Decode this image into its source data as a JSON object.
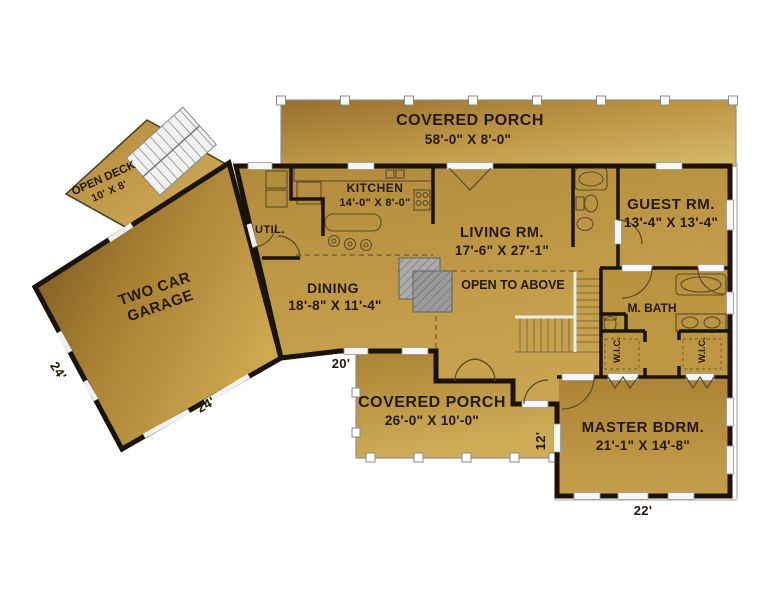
{
  "plan": {
    "rooms": {
      "porch_top": {
        "name": "COVERED PORCH",
        "dims": "58'-0\" X 8'-0\""
      },
      "kitchen": {
        "name": "KITCHEN",
        "dims": "14'-0\" X 8'-0\""
      },
      "util": {
        "name": "UTIL."
      },
      "guest": {
        "name": "GUEST RM.",
        "dims": "13'-4\" X 13'-4\""
      },
      "living": {
        "name": "LIVING RM.",
        "dims": "17'-6\" X 27'-1\""
      },
      "open_above": {
        "name": "OPEN TO ABOVE"
      },
      "dining": {
        "name": "DINING",
        "dims": "18'-8\" X 11'-4\""
      },
      "mbath": {
        "name": "M. BATH"
      },
      "wic_left": {
        "name": "W.I.C."
      },
      "wic_right": {
        "name": "W.I.C."
      },
      "garage": {
        "line1": "TWO CAR",
        "line2": "GARAGE"
      },
      "deck": {
        "name": "OPEN DECK",
        "dims": "10' X 8'"
      },
      "porch_bottom": {
        "name": "COVERED PORCH",
        "dims": "26'-0\" X 10'-0\""
      },
      "master": {
        "name": "MASTER BDRM.",
        "dims": "21'-1\" X 14'-8\""
      }
    },
    "dimensions": {
      "garage_left": "24'",
      "garage_bottom": "24'",
      "entry": "20'",
      "porch_right": "12'",
      "master_bottom": "22'"
    },
    "colors": {
      "floor_gold_light": "#cda64f",
      "floor_gold_dark": "#9a7531",
      "garage_dark": "#6d4f20",
      "wall_black": "#1b1208",
      "fireplace_gray": "#a8a8a8",
      "background": "#ffffff"
    }
  }
}
